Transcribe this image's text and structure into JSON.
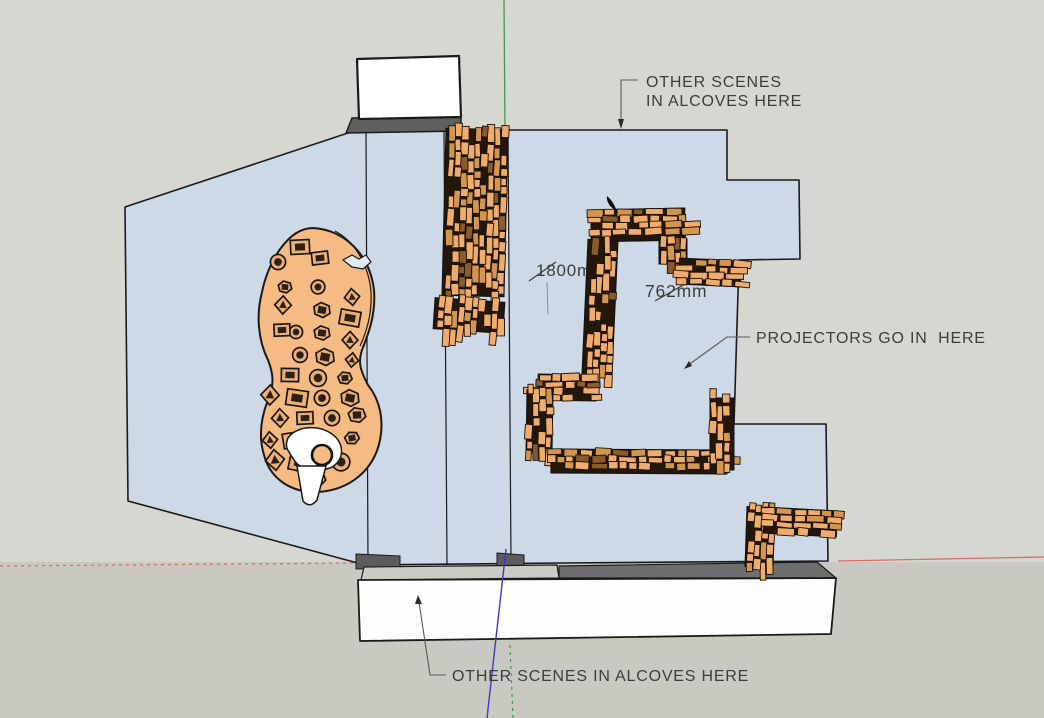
{
  "viewport": {
    "app": "3D model viewport",
    "annotations": {
      "alcoves_top": {
        "line1": "OTHER SCENES",
        "line2": "IN ALCOVES HERE"
      },
      "projectors": {
        "text": "PROJECTORS GO IN  HERE"
      },
      "alcoves_bottom": {
        "text": "OTHER SCENES IN ALCOVES HERE"
      },
      "dimension_height": {
        "text": "1800mm"
      },
      "dimension_width": {
        "text": "762mm"
      }
    },
    "colors": {
      "background_sky": "#d7d7d1",
      "background_ground": "#c9c9c1",
      "floor_plan": "#cdd9e6",
      "plan_outline": "#1a1a1a",
      "wall_brick_light": "#f0ac6d",
      "wall_brick_mid": "#d3964f",
      "wall_brick_dark": "#8a5c2c",
      "wall_mortar": "#241709",
      "scene_island": "#f5bb82",
      "prop_fill": "#efae72",
      "prop_detail": "#2b2118",
      "axis_red": "#d96a6a",
      "axis_green": "#3f9e3f",
      "axis_blue": "#3b3bc4",
      "annotation_text": "#3d3d3d",
      "leader_line": "#5a5a5a",
      "platform_white": "#fdfdfd",
      "platform_top_light": "#cbcbc5",
      "platform_top_dark": "#6e6e6e",
      "box_white": "#ffffff",
      "box_band": "#5f5f5f",
      "cutout_white": "#ffffff",
      "notch_fill": "#e3e9ef"
    }
  }
}
